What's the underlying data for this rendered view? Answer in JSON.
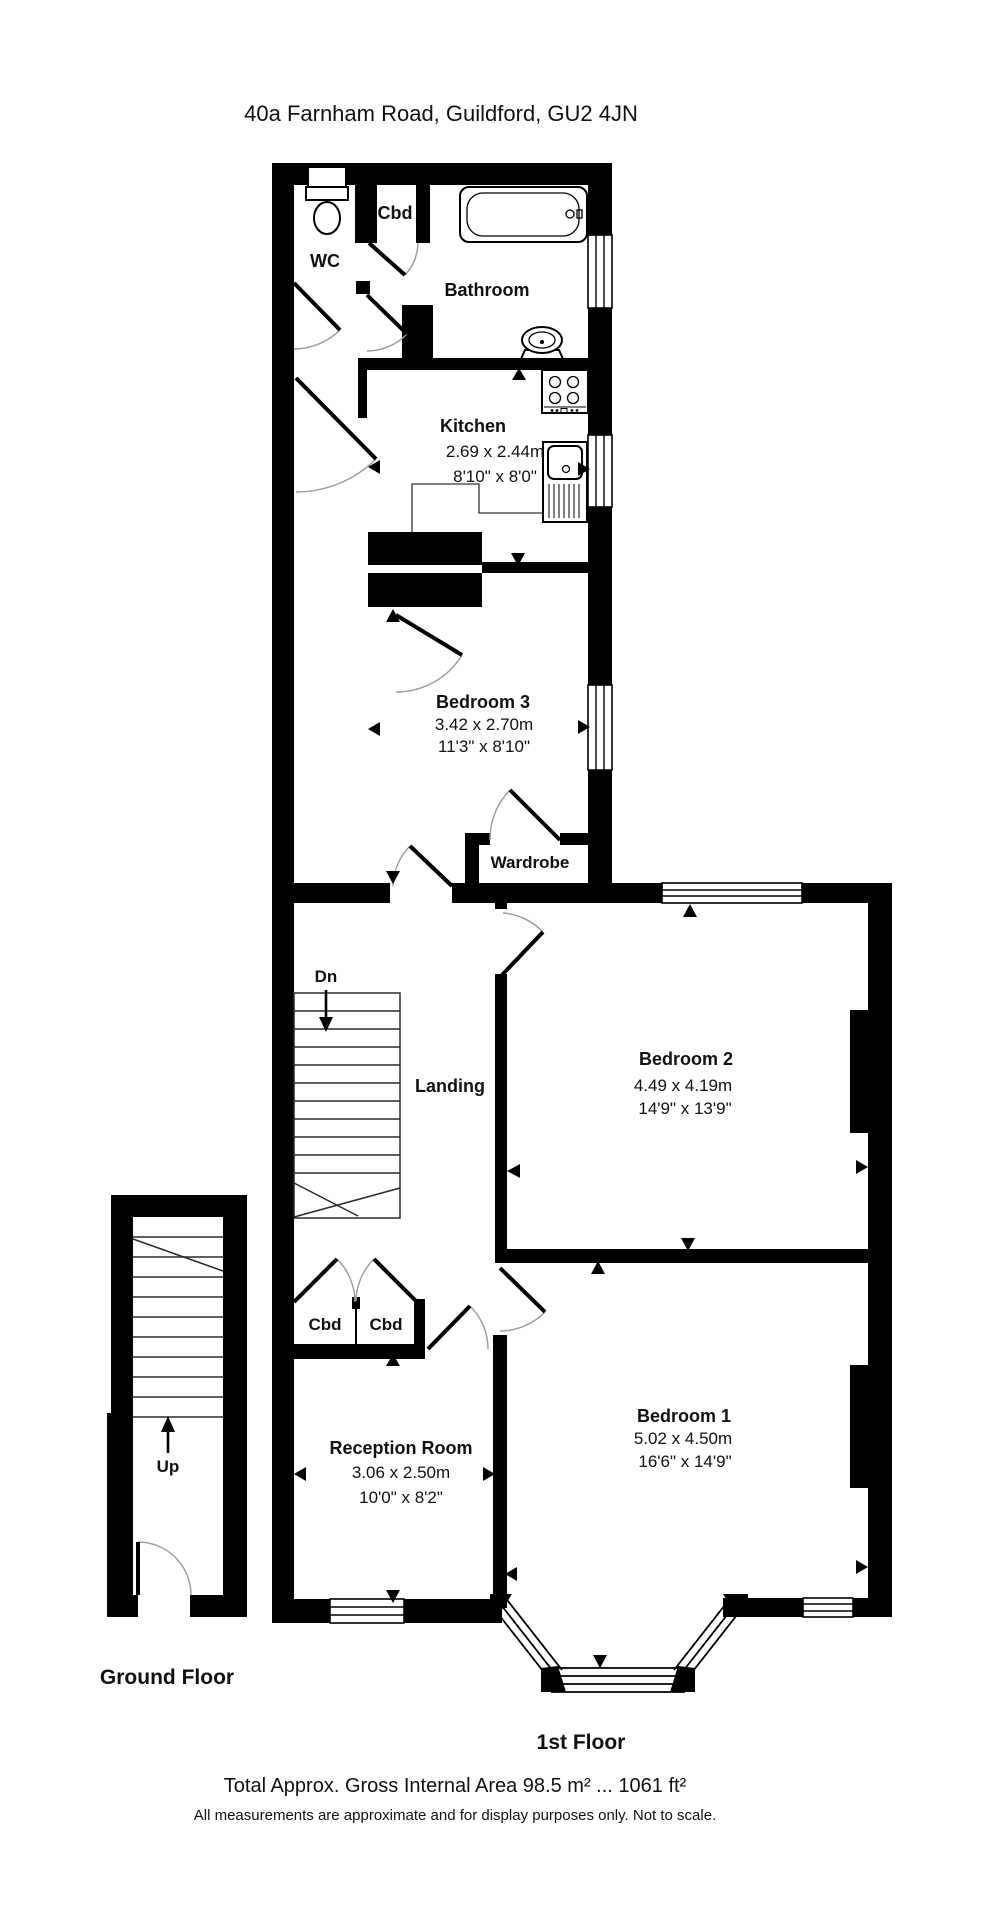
{
  "title": "40a Farnham Road, Guildford, GU2 4JN",
  "floor_labels": {
    "ground": "Ground Floor",
    "first": "1st Floor"
  },
  "footer": {
    "area": "Total Approx. Gross Internal Area 98.5 m² ... 1061 ft²",
    "disclaimer": "All measurements are approximate and for display purposes only. Not to scale."
  },
  "stairs": {
    "down": "Dn",
    "up": "Up"
  },
  "rooms": {
    "wc": {
      "name": "WC"
    },
    "cbd_top": {
      "name": "Cbd"
    },
    "bathroom": {
      "name": "Bathroom"
    },
    "kitchen": {
      "name": "Kitchen",
      "dims_m": "2.69 x 2.44m",
      "dims_ft": "8'10\" x 8'0\""
    },
    "bedroom3": {
      "name": "Bedroom 3",
      "dims_m": "3.42 x 2.70m",
      "dims_ft": "11'3\" x 8'10\""
    },
    "wardrobe": {
      "name": "Wardrobe"
    },
    "landing": {
      "name": "Landing"
    },
    "bedroom2": {
      "name": "Bedroom 2",
      "dims_m": "4.49 x 4.19m",
      "dims_ft": "14'9\" x 13'9\""
    },
    "cbd_left": {
      "name": "Cbd"
    },
    "cbd_right": {
      "name": "Cbd"
    },
    "reception": {
      "name": "Reception Room",
      "dims_m": "3.06 x 2.50m",
      "dims_ft": "10'0\" x 8'2\""
    },
    "bedroom1": {
      "name": "Bedroom 1",
      "dims_m": "5.02 x 4.50m",
      "dims_ft": "16'6\" x 14'9\""
    }
  },
  "colors": {
    "wall": "#000000",
    "background": "#ffffff",
    "door_arc": "#9a9a9a"
  }
}
